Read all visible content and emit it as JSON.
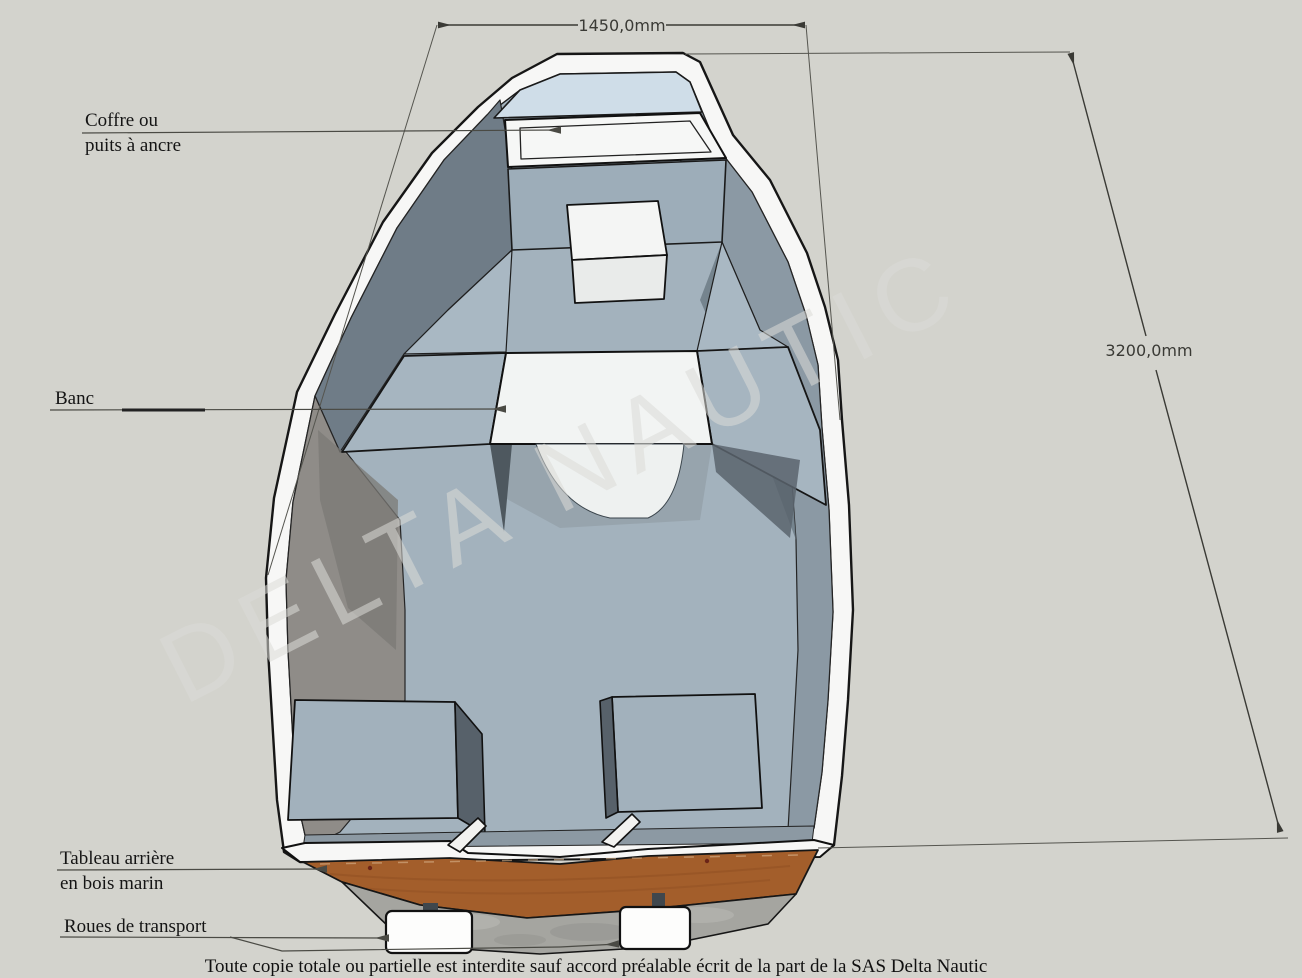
{
  "document": {
    "type": "boat-technical-diagram",
    "watermark": "DELTA NAUTIC",
    "footer_notice": "Toute copie totale ou partielle est interdite sauf accord préalable écrit de la part de la SAS Delta Nautic"
  },
  "labels": {
    "anchor_locker_line1": "Coffre ou",
    "anchor_locker_line2": "puits à ancre",
    "bench": "Banc",
    "transom_line1": "Tableau arrière",
    "transom_line2": "en bois marin",
    "transport_wheels": "Roues de transport"
  },
  "dimensions": {
    "beam": "1450,0mm",
    "length": "3200,0mm"
  },
  "colors": {
    "background": "#d3d3cd",
    "hull_white": "#f7f7f6",
    "floor_blue_gray": "#a3b2bd",
    "side_deck": "#a9b8c3",
    "bow_deck_blue": "#cfdde8",
    "bench_white": "#f2f4f3",
    "wall_warm_gray": "#8f8c88",
    "wall_cool_gray": "#6f7c87",
    "transom_wood_brown": "#a35e2b",
    "hull_bottom_concrete": "#a5a5a0",
    "outline_black": "#1a1a1a",
    "dimension_gray": "#3a3a35"
  }
}
